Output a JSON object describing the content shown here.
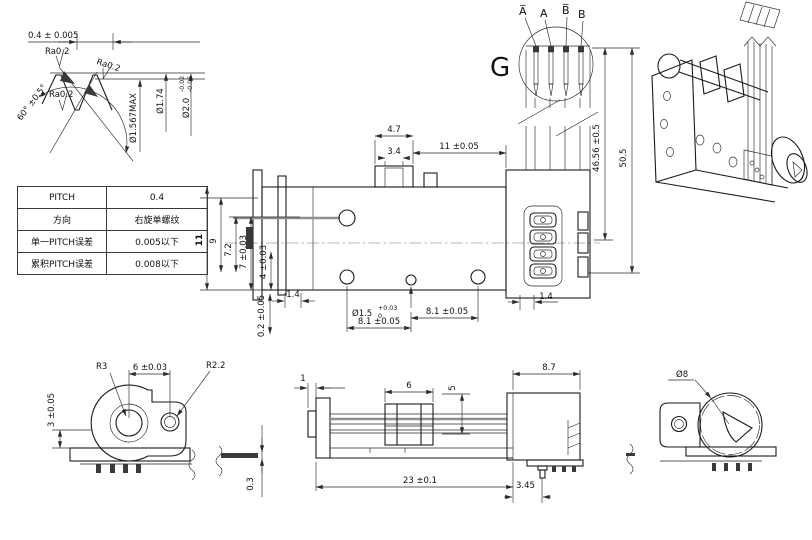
{
  "thread_detail": {
    "pitch_dim": "0.4 ± 0.005",
    "ra_top": "Ra0.2",
    "ra_mid": "Ra0.2",
    "ra_bottom": "Ra0.2",
    "angle_dim": "60° ±0.5°",
    "dia_root": "Ø1.567MAX",
    "dia_pitch": "Ø1.74",
    "dia_major": "Ø2.0",
    "dia_major_tol_hi": "-0.02",
    "dia_major_tol_lo": "-0.06"
  },
  "spec_table": {
    "rows": [
      {
        "label": "PITCH",
        "value": "0.4"
      },
      {
        "label": "方向",
        "value": "右旋单螺纹"
      },
      {
        "label": "单一PITCH误差",
        "value": "0.005以下"
      },
      {
        "label": "累积PITCH误差",
        "value": "0.008以下"
      }
    ]
  },
  "top_view": {
    "dim_carriage": "4.7",
    "dim_slot": "3.4",
    "dim_travel": "11 ±0.05",
    "dim_h11": "11",
    "dim_h9": "9",
    "dim_h72": "7.2",
    "dim_h7": "7 ±0.03",
    "dim_h4": "4 ±0.03",
    "dim_02": "0.2 ±0.05",
    "dim_14_left": "1.4",
    "hole_dia": "Ø1.5",
    "hole_tol_hi": "+0.03",
    "hole_tol_lo": "0",
    "dim_81_left": "8.1 ±0.05",
    "dim_81_right": "8.1 ±0.05",
    "dim_14_right": "1.4"
  },
  "detail_g": {
    "label": "G",
    "terminal_1": "A̅",
    "terminal_2": "A",
    "terminal_3": "B̅",
    "terminal_4": "B"
  },
  "fpc_dims": {
    "dim_length": "46.56 ±0.5",
    "dim_total": "50.5"
  },
  "front_view": {
    "radius_big": "R3",
    "dim_centers": "6 ±0.03",
    "radius_small": "R2.2",
    "dim_plate": "3 ±0.05"
  },
  "pin_detail": {
    "dim_thickness": "0.3"
  },
  "side_view": {
    "dim_tip": "1",
    "dim_carriage": "6",
    "dim_height": "5",
    "dim_motor": "8.7",
    "dim_overall": "23 ±0.1",
    "dim_bracket": "3.45"
  },
  "rear_view": {
    "dia_motor": "Ø8"
  }
}
